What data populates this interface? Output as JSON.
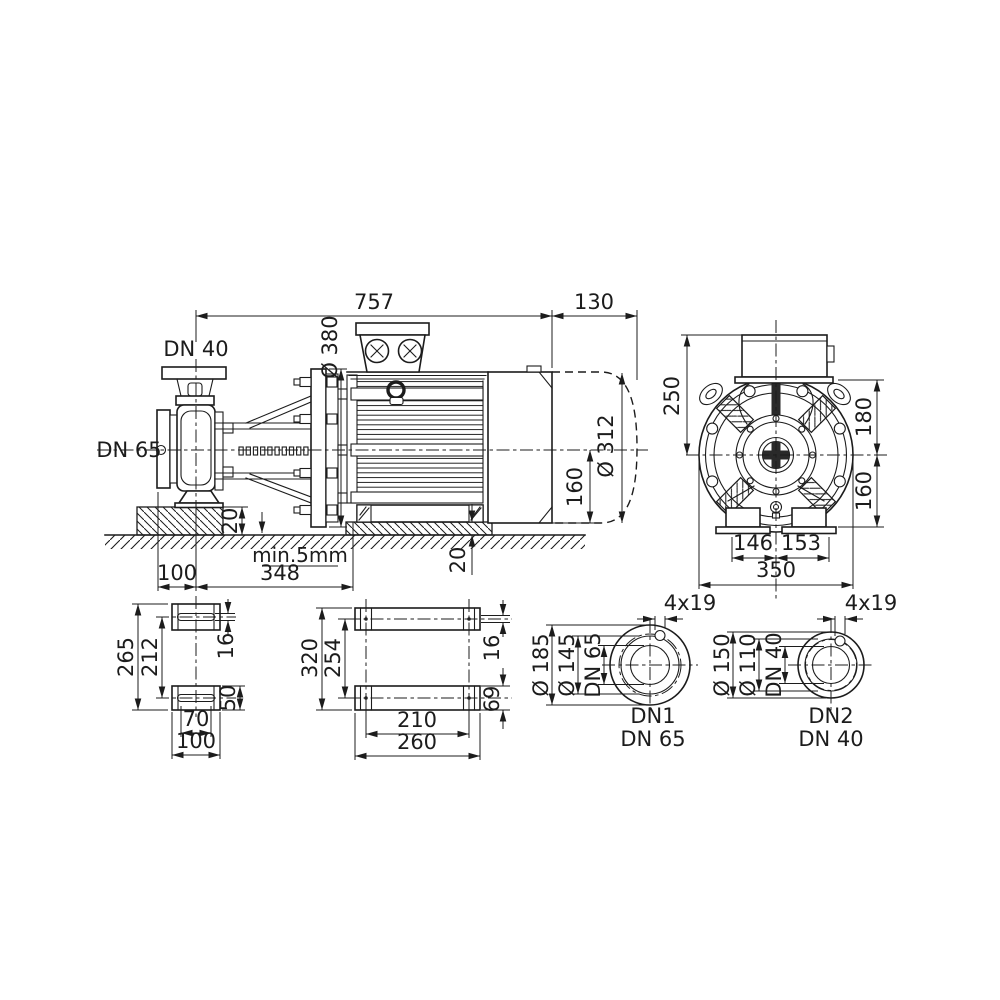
{
  "side_view": {
    "port_labels": {
      "discharge": "DN 40",
      "suction": "DN 65"
    },
    "dims": {
      "overall_length": "757",
      "motor_overhang": "130",
      "flange_diameter": "Ø 380",
      "motor_diameter": "Ø 312",
      "shaft_height": "160",
      "foundation_height": "20",
      "foot_pad_height": "20",
      "grout_gap": "min.5mm",
      "suction_face_to_axis": "100",
      "axis_to_motor_foot": "348"
    }
  },
  "front_view": {
    "dims": {
      "box_top_to_axis": "250",
      "axis_to_motor_top": "180",
      "axis_to_base": "160",
      "foot_left": "146",
      "foot_right": "153",
      "overall_width": "350"
    }
  },
  "pump_foot_plan": {
    "dims": {
      "outer_length": "265",
      "bolt_spacing": "212",
      "slot_width": "16",
      "pad_length": "50",
      "slot_spacing": "70",
      "pad_width": "100"
    }
  },
  "motor_foot_plan": {
    "dims": {
      "outer_length": "320",
      "bolt_spacing": "254",
      "hole_width": "16",
      "foot_length": "69",
      "bolt_width_spacing": "210",
      "foot_width": "260"
    }
  },
  "flange_dn1": {
    "dims": {
      "outer_diameter": "Ø 185",
      "bolt_circle": "Ø 145",
      "nominal_bore": "DN 65",
      "bolt_holes": "4x19"
    },
    "caption": {
      "line1": "DN1",
      "line2": "DN 65"
    }
  },
  "flange_dn2": {
    "dims": {
      "outer_diameter": "Ø 150",
      "bolt_circle": "Ø 110",
      "nominal_bore": "DN 40",
      "bolt_holes": "4x19"
    },
    "caption": {
      "line1": "DN2",
      "line2": "DN 40"
    }
  }
}
